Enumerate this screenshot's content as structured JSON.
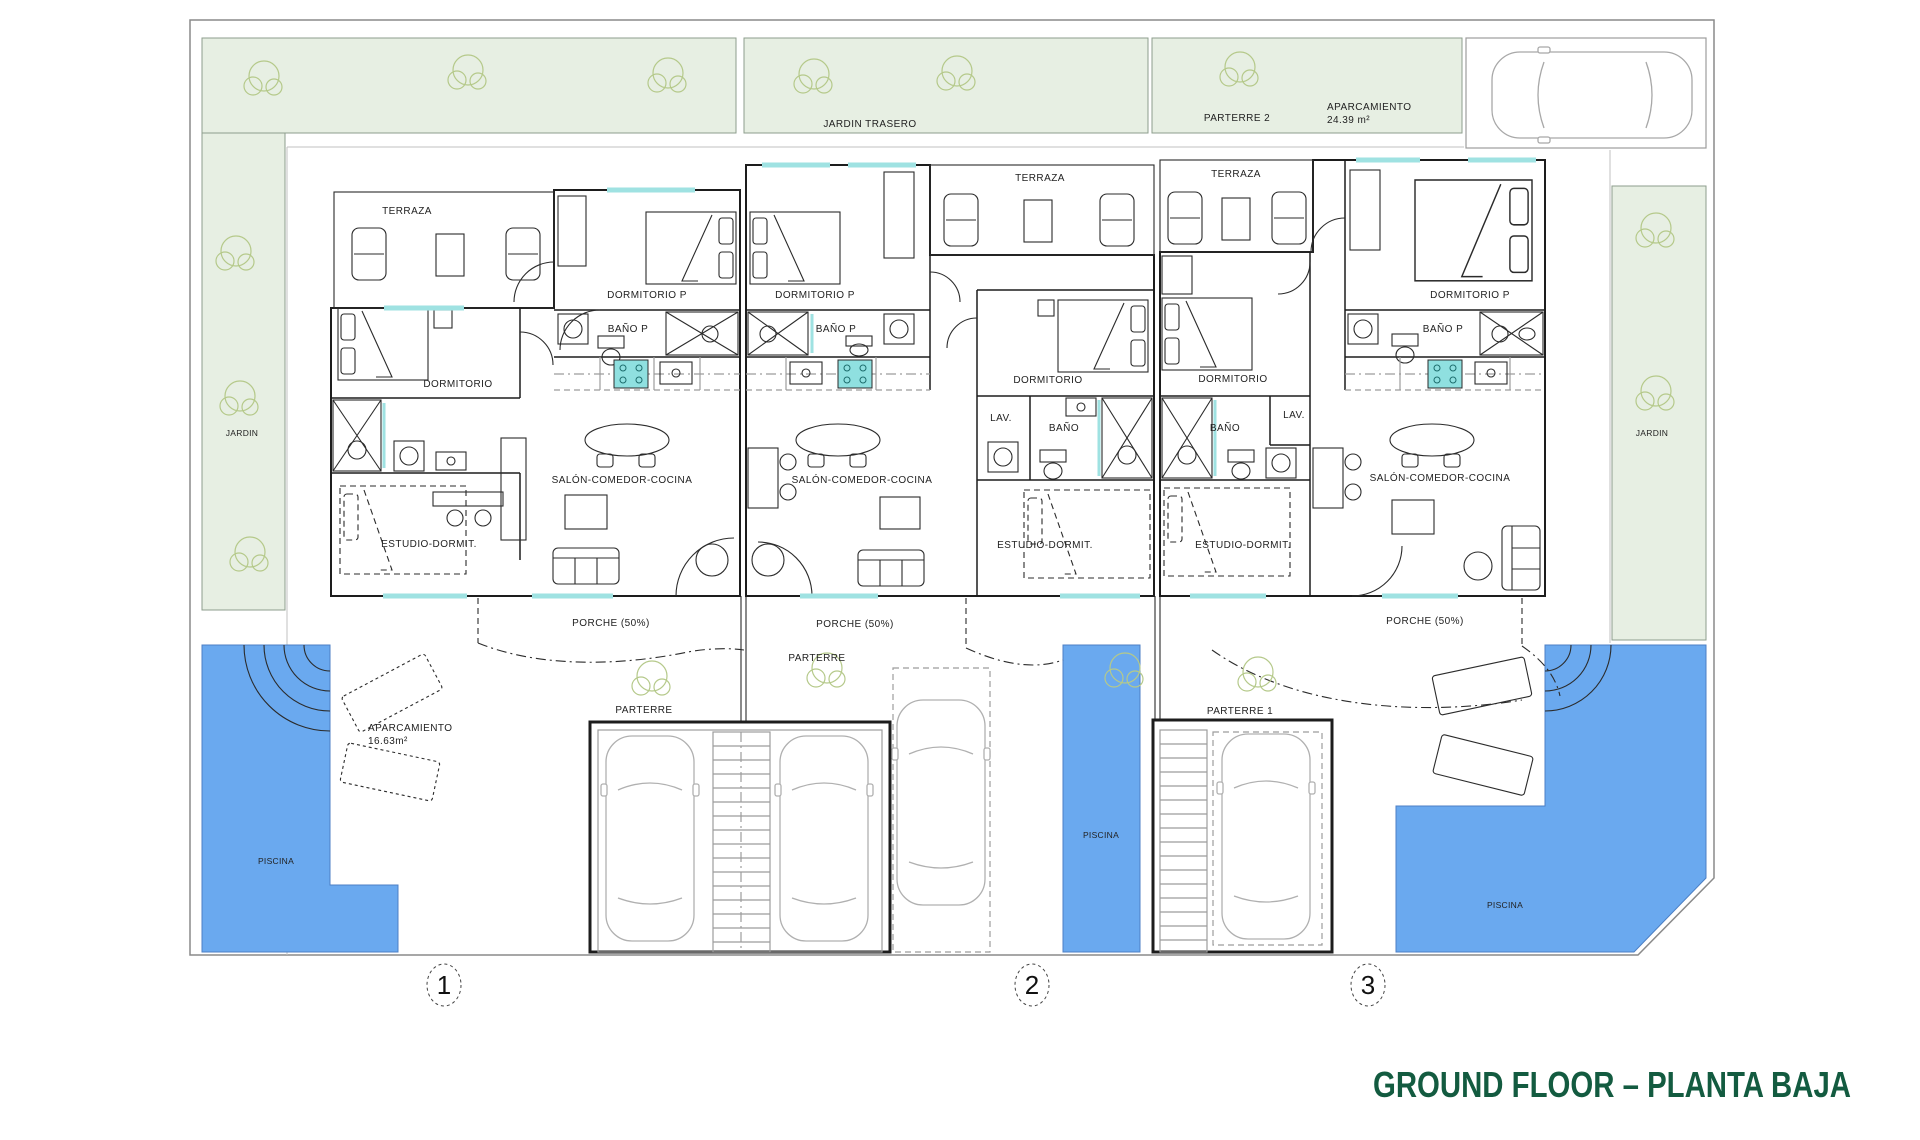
{
  "title": {
    "text": "GROUND FLOOR – PLANTA BAJA"
  },
  "colors": {
    "garden_green": "#e7efe3",
    "pool_blue": "#6aa9ef",
    "unit1_fill": "#f9f6cf",
    "unit2_fill": "#f9e5d2",
    "unit3_fill": "#e6d2d5",
    "terrace_white": "#ffffff",
    "window_cyan": "#9fe2e2",
    "title_green": "#135b40",
    "tree_stroke": "#b5c98a"
  },
  "site": {
    "jardin_trasero": "JARDIN TRASERO",
    "parterre_2": "PARTERRE 2",
    "parking_top": {
      "label": "APARCAMIENTO",
      "area": "24.39 m²"
    },
    "jardin_left": "JARDIN",
    "jardin_right": "JARDIN",
    "parterre_center": "PARTERRE",
    "parterre_left": "PARTERRE",
    "parterre_1": "PARTERRE 1",
    "parking_front": {
      "label": "APARCAMIENTO",
      "area": "16.63m²"
    },
    "pool_left": "PISCINA",
    "pool_center": "PISCINA",
    "pool_right": "PISCINA"
  },
  "units": [
    {
      "number": "1",
      "terraza": "TERRAZA",
      "dormitorio_p": "DORMITORIO P",
      "bano_p": "BAÑO P",
      "dormitorio": "DORMITORIO",
      "salon": "SALÓN-COMEDOR-COCINA",
      "estudio": "ESTUDIO-DORMIT.",
      "porche": "PORCHE (50%)"
    },
    {
      "number": "2",
      "terraza": "TERRAZA",
      "dormitorio_p": "DORMITORIO P",
      "bano_p": "BAÑO P",
      "dormitorio": "DORMITORIO",
      "lav": "LAV.",
      "bano": "BAÑO",
      "salon": "SALÓN-COMEDOR-COCINA",
      "estudio": "ESTUDIO-DORMIT.",
      "porche": "PORCHE (50%)"
    },
    {
      "number": "3",
      "terraza": "TERRAZA",
      "dormitorio": "DORMITORIO",
      "bano": "BAÑO",
      "lav": "LAV.",
      "dormitorio_p": "DORMITORIO P",
      "bano_p": "BAÑO P",
      "salon": "SALÓN-COMEDOR-COCINA",
      "estudio": "ESTUDIO-DORMIT.",
      "porche": "PORCHE (50%)"
    }
  ]
}
